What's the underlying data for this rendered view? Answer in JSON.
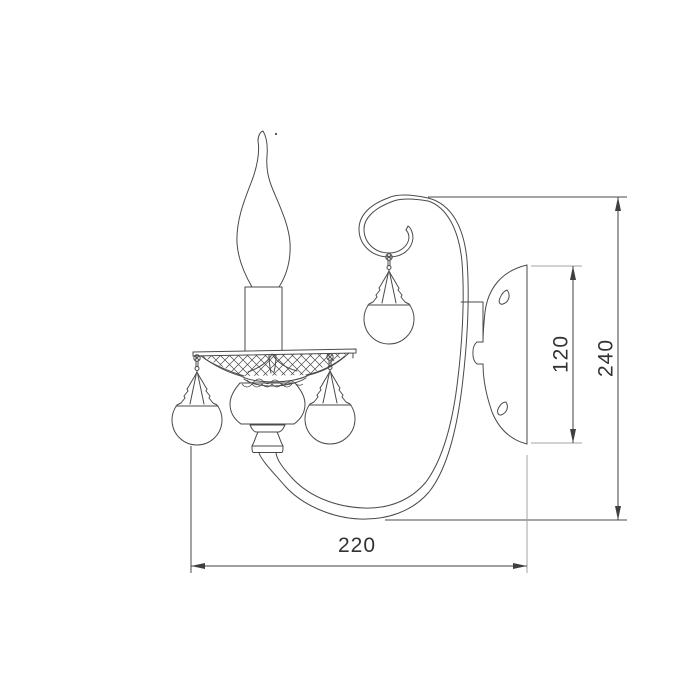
{
  "drawing": {
    "type": "technical-line-drawing",
    "subject": "wall sconce with flame candle bulb, crystal pendants and scroll arm",
    "dimensions": {
      "width": "220",
      "backplate_height": "120",
      "overall_height": "240"
    },
    "colors": {
      "line": "#4a4a4a",
      "extension_line": "#a3a3a3",
      "dimension_line": "#3f3f3f",
      "text": "#333333",
      "background": "#ffffff"
    }
  }
}
